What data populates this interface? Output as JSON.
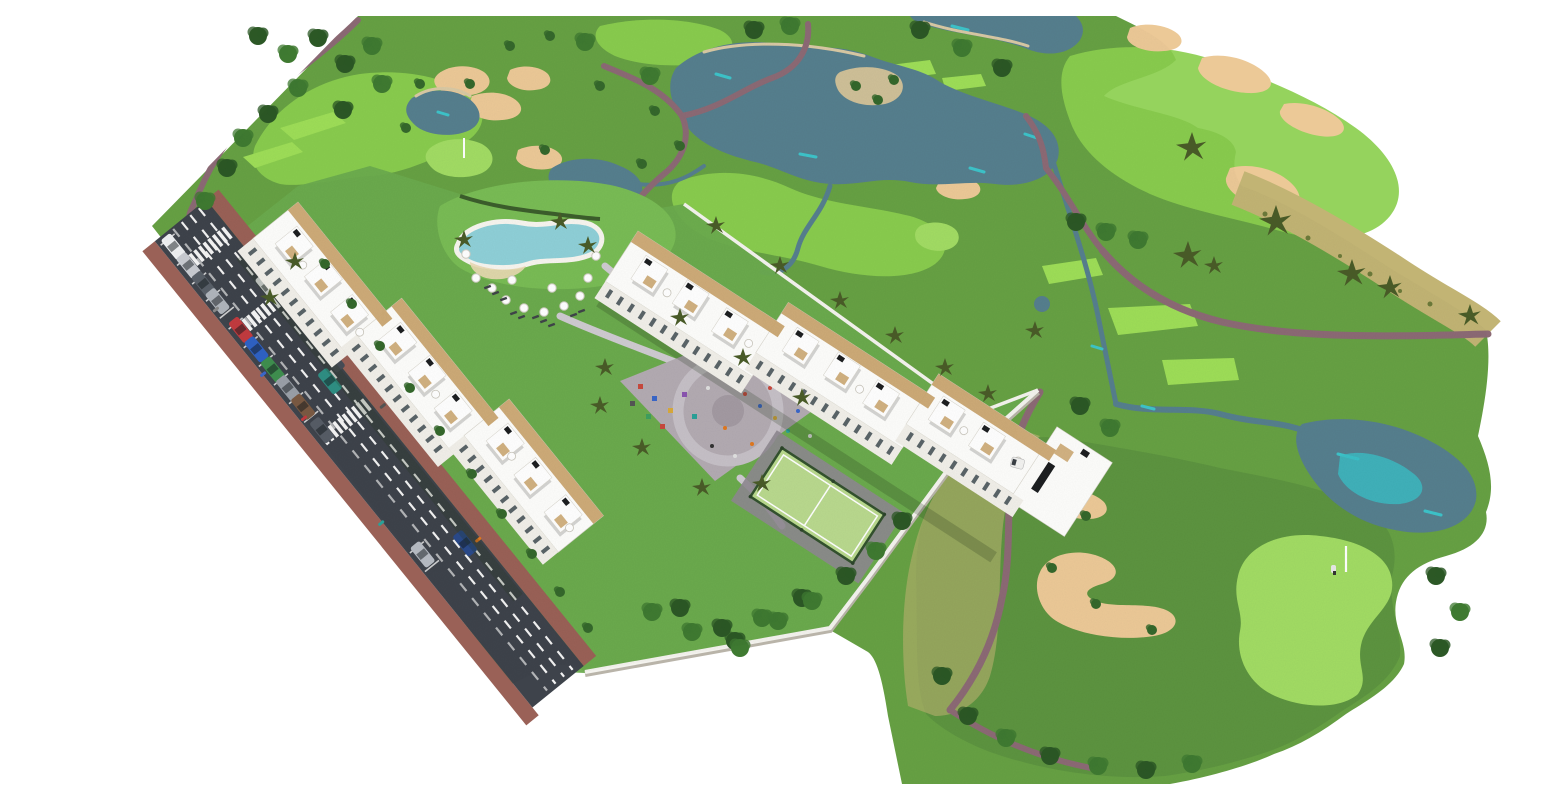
{
  "meta": {
    "type": "aerial-3d-architectural-render",
    "subject": "Aerial rendering of a white apartment resort complex beside a golf course, with access road, lagoon pool, playground plaza, padel court, lakes, bunkers and putting green"
  },
  "watermark": {
    "text": "www.vistao",
    "color": "#ffffff"
  },
  "palette": {
    "white_bg": "#ffffff",
    "rough": "#67a144",
    "rough_dark": "#5d9440",
    "fairway": "#8ccf4f",
    "tee": "#9ede58",
    "green": "#a2dc64",
    "sand": "#ecc997",
    "sand_shade": "#d9a96c",
    "sandbar": "#d9c9a4",
    "scrub": "#c2b474",
    "water": "#567f8e",
    "water_deep": "#49707f",
    "water_accent": "#3cc8ce",
    "cart_path": "#8c6a75",
    "asphalt": "#3e434b",
    "lane_mark": "#f2f2f2",
    "sidewalk": "#9a6157",
    "lawn": "#6cab4e",
    "lawn_light": "#79bc55",
    "hedge": "#3c5e2c",
    "tree_dark": "#2c5826",
    "tree_mid": "#3f7a31",
    "tree_small": "#35682c",
    "palm": "#4a5c28",
    "building": "#fdfdfb",
    "building_face": "#f1efe9",
    "wood": "#caa46c",
    "glass": "#5a6468",
    "roof_unit": "#1d1f21",
    "wall": "#f4f3ee",
    "plaza": "#b3abb2",
    "plaza_ring": "#c6c0c7",
    "court": "#b9d98e",
    "court_fence": "#33522e",
    "pool": "#8fd0d8",
    "pool_deck": "#f7f5ef",
    "pool_beach": "#ead9b4",
    "walkway": "#cfcbd1",
    "car_red": "#c23b3f",
    "car_blue": "#2f62c4",
    "car_green": "#3f8f4f",
    "car_teal": "#2f8f84",
    "car_navy": "#2a4a8a"
  }
}
